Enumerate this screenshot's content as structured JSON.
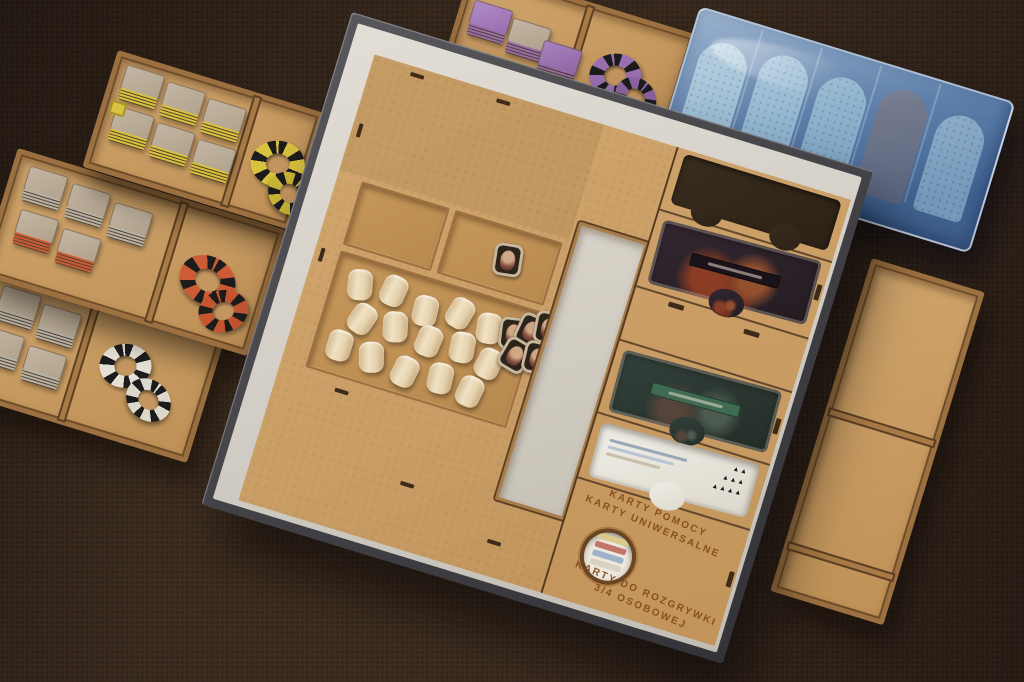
{
  "scene": {
    "description": "Photograph of a laser-cut wooden (MDF) board game box insert with component trays, wooden barrel tokens, card wells, and a blue plastic miniatures tray on a dark brown woven tablecloth"
  },
  "engravings": {
    "help_line1": "KARTY POMOCY",
    "help_line2": "KARTY UNIWERSALNE",
    "play_line1": "KARTY DO ROZGRYWKI",
    "play_line2": "3/4 OSOBOWEJ"
  },
  "help_card": {
    "pip_rows": [
      "▲▲",
      "▲▲▲",
      "▲▲▲▲"
    ]
  },
  "components": {
    "wood_barrels_count": 15,
    "portrait_tokens_pile_count": 6,
    "miniatures_visible_count": 5,
    "token_trays": [
      {
        "id": "yellow",
        "square_stacks": 6,
        "rings": "yellow-black"
      },
      {
        "id": "orange",
        "square_stacks": 5,
        "rings": "orange-black"
      },
      {
        "id": "gray",
        "square_stacks": 4,
        "rings": "white"
      },
      {
        "id": "purple",
        "square_stacks": 3,
        "rings": "purple"
      }
    ]
  },
  "colors": {
    "background": "#38291e",
    "mdf": "#c99e66",
    "mdf_dark": "#8a5f36",
    "box_exterior": "#45454a",
    "box_interior": "#d8d4cb",
    "barrel": "#ead7b8",
    "blue_base": "#1d3c74",
    "token_yellow": "#d8c23e",
    "token_orange": "#cd5b35",
    "token_gray": "#b7b2a8",
    "token_purple": "#9a6fb0",
    "engrave": "#81481c"
  }
}
